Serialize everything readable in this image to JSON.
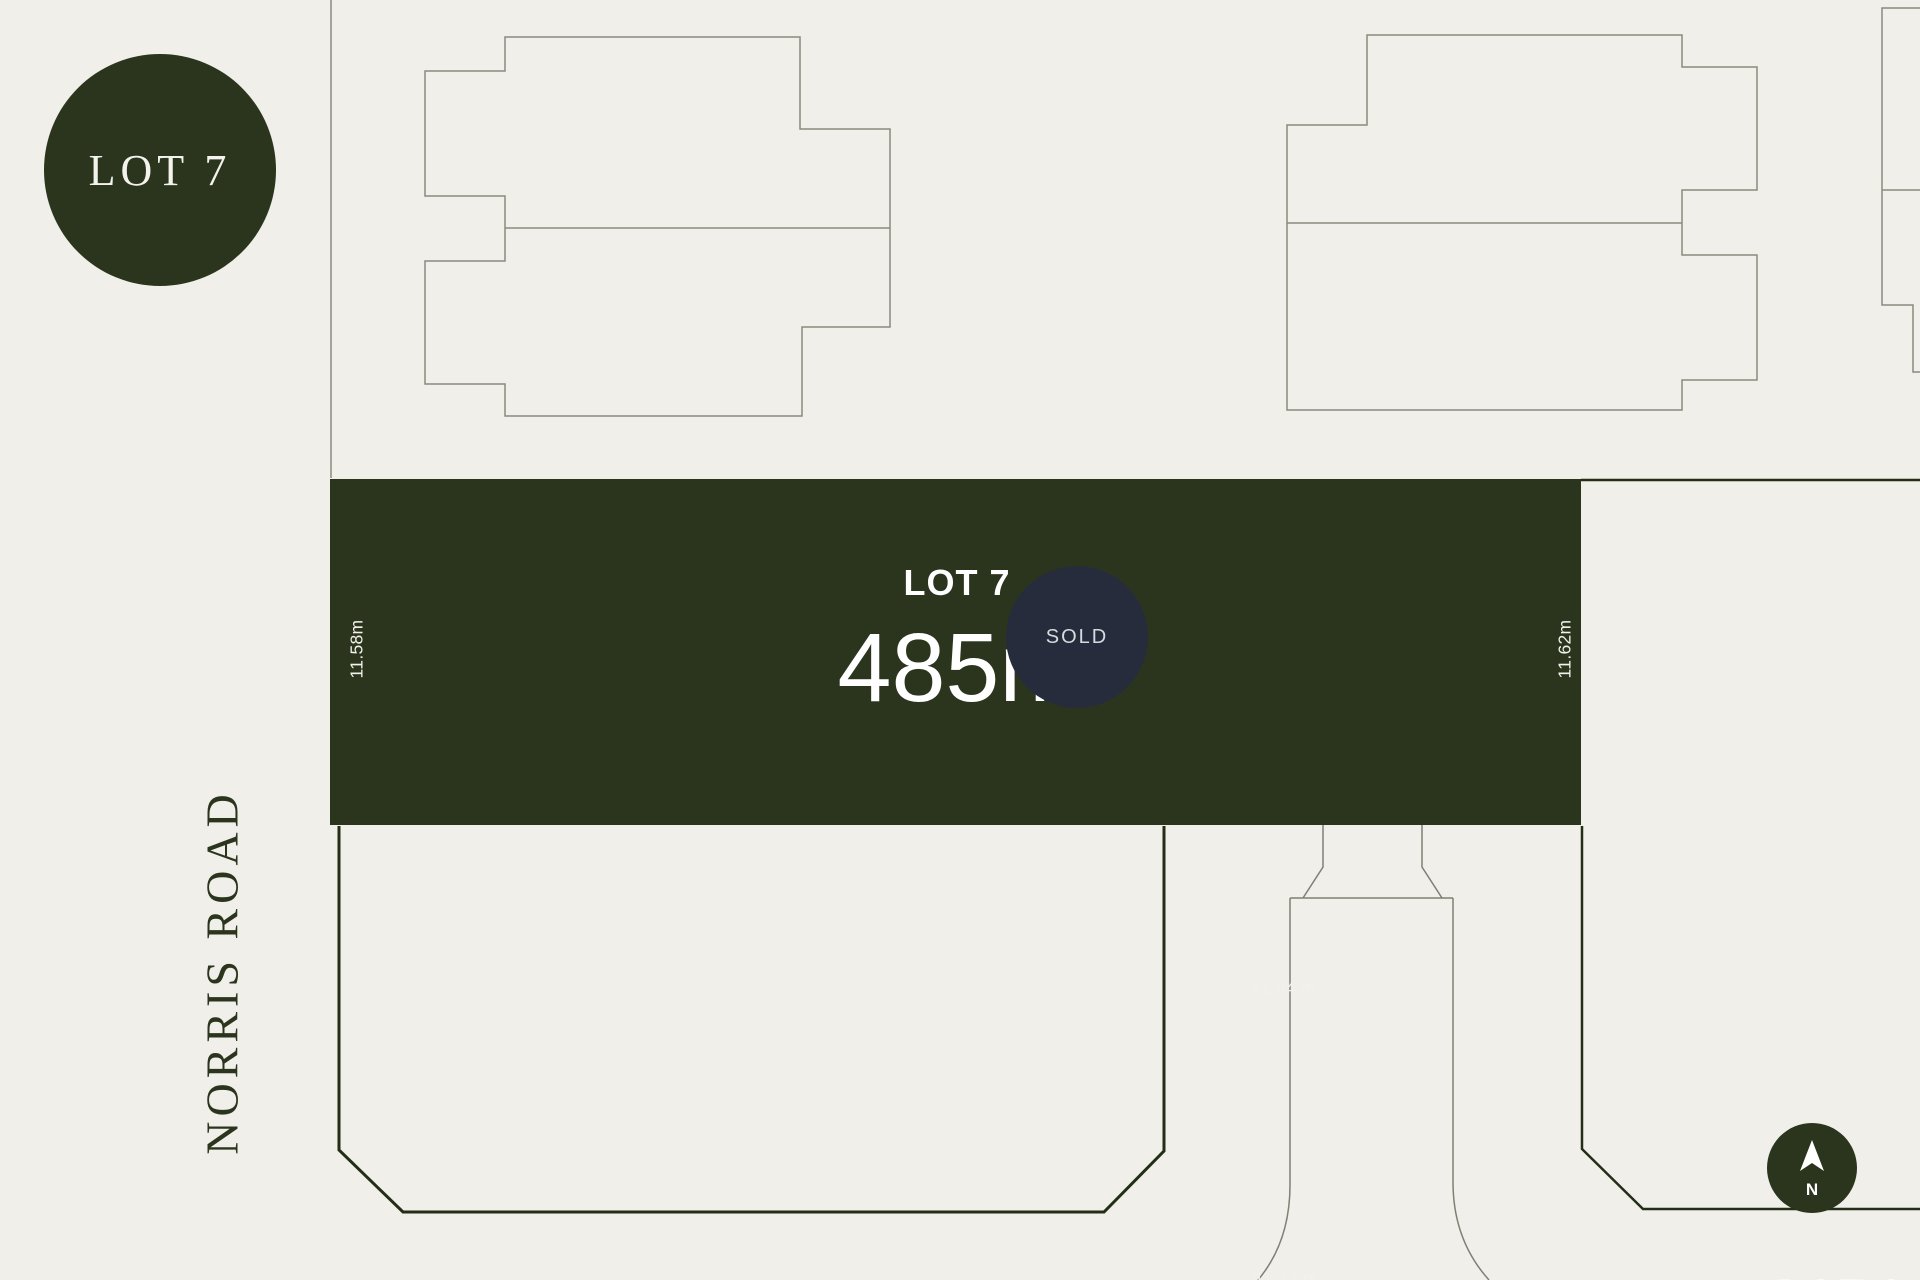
{
  "colors": {
    "background": "#f0efea",
    "green": "#2b351d",
    "navy_sold": "#262c3c",
    "line_thin": "#878b7c",
    "line_thick": "#242d16",
    "text_light": "#f2f1ec"
  },
  "badge": {
    "label": "LOT 7"
  },
  "lot": {
    "title": "LOT 7",
    "area": "485m²",
    "dim_top": "41.94 m",
    "dim_bottom": "41.74 m",
    "dim_left": "11.58m",
    "dim_right": "11.62m"
  },
  "sold": {
    "label": "SOLD"
  },
  "road": {
    "label": "NORRIS ROAD"
  },
  "north": {
    "label": "N"
  },
  "partial_lot": {
    "label": "LOT 8"
  }
}
